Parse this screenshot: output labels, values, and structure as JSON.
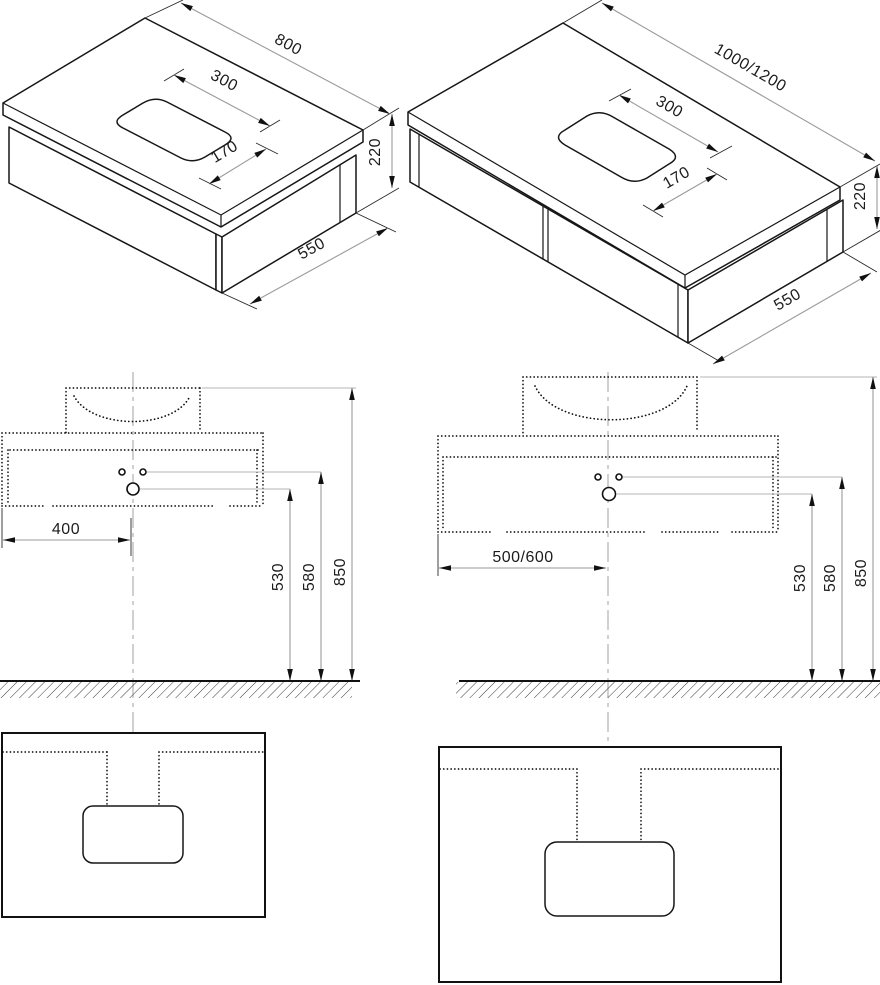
{
  "drawing_type": "bathroom vanity cabinet dimensional drawing",
  "views": {
    "iso_left": {
      "dims": {
        "width": "800",
        "cutout_length": "300",
        "cutout_depth": "170",
        "height": "220",
        "depth": "550"
      }
    },
    "iso_right": {
      "dims": {
        "width": "1000/1200",
        "cutout_length": "300",
        "cutout_depth": "170",
        "height": "220",
        "depth": "550"
      }
    },
    "elev_left": {
      "dims": {
        "wall_offset": "400",
        "drain_height": "530",
        "taps_height": "580",
        "top_height": "850"
      }
    },
    "elev_right": {
      "dims": {
        "wall_offset": "500/600",
        "drain_height": "530",
        "taps_height": "580",
        "top_height": "850"
      }
    }
  },
  "colors": {
    "background": "#ffffff",
    "object_line": "#161616",
    "dimension_line": "#9a9a9a",
    "center_line": "#c8c8c8",
    "text": "#1c1c1c"
  }
}
